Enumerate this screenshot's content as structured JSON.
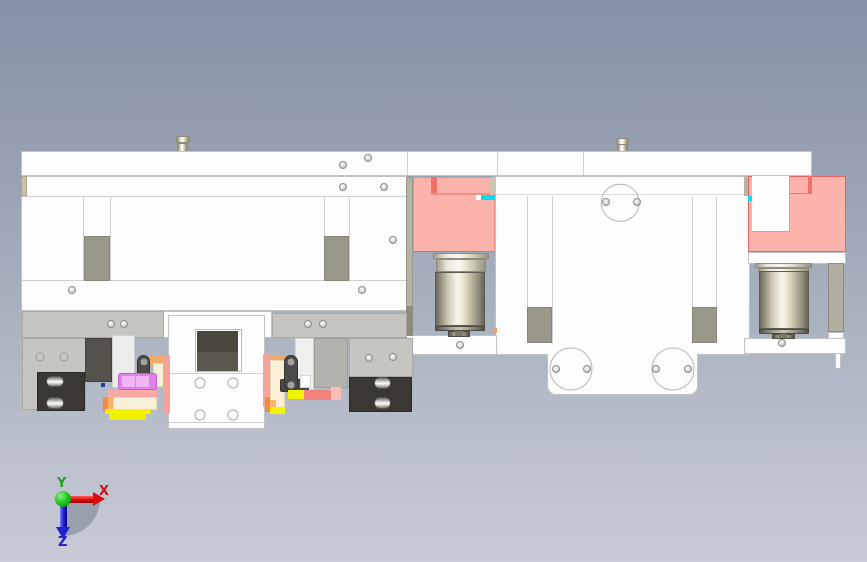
{
  "view": {
    "type": "cad-viewport",
    "description": "Front orthographic view of a mechanical gripper / pick-and-place assembly with two pneumatic cylinders and pink clamp blocks"
  },
  "triad": {
    "x_label": "X",
    "y_label": "Y",
    "z_label": "Z",
    "x_color": "#d51010",
    "y_color": "#1ca01c",
    "z_color": "#2020cc",
    "origin_color": "#22c822"
  },
  "palette": {
    "background_top": "#8691a6",
    "background_bottom": "#c7cbd7",
    "part_white": "#fdfdfd",
    "edge_gray": "#c2c2c2",
    "clamp_pink": "#fbb3ab",
    "clamp_red_edge": "#f06f66",
    "selection_cyan": "#00dff5",
    "slider_gray": "#9a978b",
    "plate_gray": "#c6c5c0",
    "dark_block": "#3b3833",
    "gripper_magenta": "#e083e8",
    "gripper_yellow": "#f4f400",
    "gripper_salmon": "#f2a49a",
    "gripper_orange": "#ef8c43",
    "gripper_cream": "#f7efd6",
    "motor_metal_light": "#f8f6ee",
    "motor_metal_dark": "#6b695e"
  },
  "parts": [
    "top-base-plate",
    "left-frame-plate",
    "central-frame-plate",
    "pink-clamp-left",
    "pink-clamp-right",
    "cylinder-left",
    "cylinder-right",
    "guide-rail-blocks",
    "gripper-mechanism-left",
    "gripper-mechanism-right",
    "center-pusher-block",
    "mount-pins",
    "orientation-triad"
  ]
}
